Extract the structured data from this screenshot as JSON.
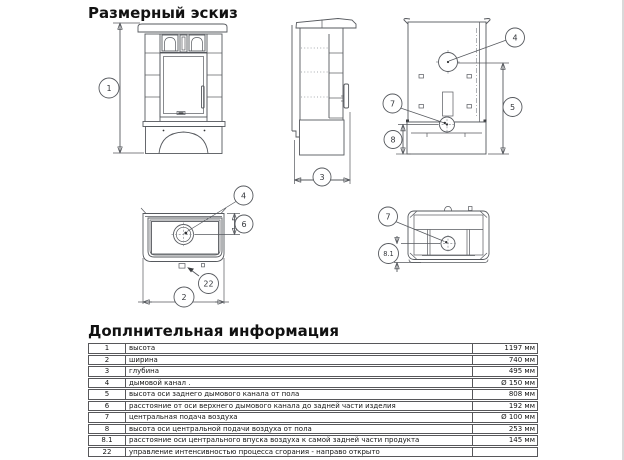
{
  "page": {
    "title": "Размерный эскиз",
    "section_title": "Доплнительная информация"
  },
  "diagram": {
    "callouts": {
      "height": "1",
      "width": "2",
      "depth": "3",
      "flue": "4",
      "flue_axis_height": "5",
      "flue_axis_offset": "6",
      "air_inlet": "7",
      "air_axis_height": "8",
      "air_axis_offset": "8.1",
      "combustion_control": "22"
    }
  },
  "table": {
    "rows": [
      {
        "num": "1",
        "desc": "высота",
        "value": "1197 мм"
      },
      {
        "num": "2",
        "desc": "ширина",
        "value": "740 мм"
      },
      {
        "num": "3",
        "desc": "глубина",
        "value": "495 мм"
      },
      {
        "num": "4",
        "desc": "дымовой канал .",
        "value": "Ø 150 мм"
      },
      {
        "num": "5",
        "desc": "высота оси заднего дымового канала от пола",
        "value": "808 мм"
      },
      {
        "num": "6",
        "desc": "расстояние от оси верхнего дымового канала до задней части изделия",
        "value": "192 мм"
      },
      {
        "num": "7",
        "desc": "центральная подача воздуха",
        "value": "Ø 100 мм"
      },
      {
        "num": "8",
        "desc": "высота оси центральной подачи воздуха от пола",
        "value": "253 мм"
      },
      {
        "num": "8.1",
        "desc": "расстояние оси центрального впуска воздуха к самой задней части продукта",
        "value": "145 мм"
      },
      {
        "num": "22",
        "desc": "управление интенсивностью процесса сгорания - направо открыто",
        "value": ""
      }
    ]
  }
}
